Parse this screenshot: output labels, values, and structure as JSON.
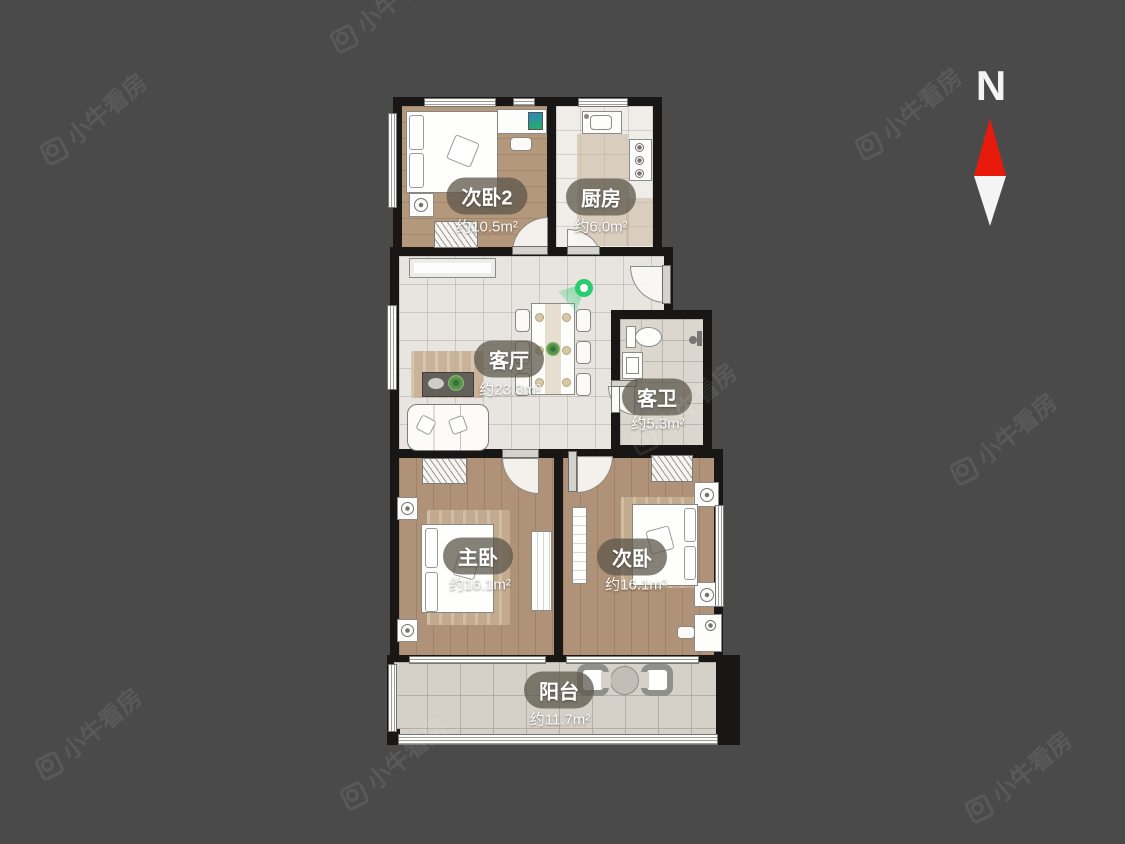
{
  "plan": {
    "rooms": [
      {
        "key": "bedroom2",
        "name": "次卧2",
        "area": "约10.5m²"
      },
      {
        "key": "kitchen",
        "name": "厨房",
        "area": "约6.0m²"
      },
      {
        "key": "living",
        "name": "客厅",
        "area": "约23.3m²"
      },
      {
        "key": "bathroom",
        "name": "客卫",
        "area": "约5.3m²"
      },
      {
        "key": "master",
        "name": "主卧",
        "area": "约16.1m²"
      },
      {
        "key": "bedroom",
        "name": "次卧",
        "area": "约16.1m²"
      },
      {
        "key": "balcony",
        "name": "阳台",
        "area": "约11.7m²"
      }
    ]
  },
  "compass": {
    "label": "N"
  },
  "watermark": {
    "text": "小牛看房"
  },
  "colors": {
    "background": "#4a4a4a",
    "wall": "#181715",
    "wood_floor": "#b4987c",
    "tile_floor": "#e8e5e0",
    "label_pill": "#5c574b",
    "marker_green": "#29cd6f",
    "compass_red": "#e81a0c"
  }
}
